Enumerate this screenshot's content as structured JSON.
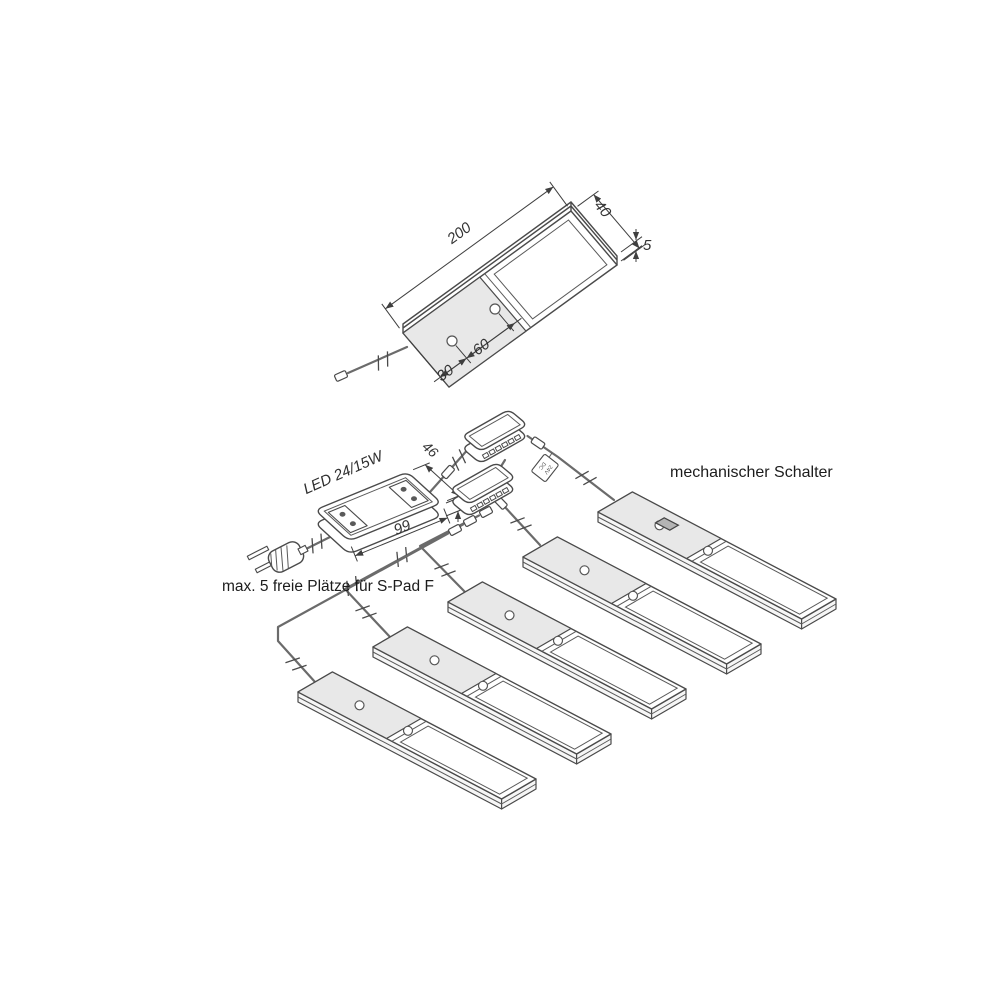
{
  "product_drawing": {
    "length": "200",
    "width": "40",
    "thickness": "5",
    "hole_edge_distance": "30",
    "hole_spacing": "60"
  },
  "driver": {
    "label": "LED 24/15W",
    "width": "46",
    "height": "15",
    "length": "99"
  },
  "cable_tag": {
    "line1": "24V",
    "line2": "DC"
  },
  "labels": {
    "switch": "mechanischer Schalter",
    "note": "max. 5 freie Plätze für S-Pad F"
  },
  "distributors": {
    "count": 2,
    "ports_each": 6
  },
  "panels": {
    "count": 5
  },
  "colors": {
    "background": "#ffffff",
    "line": "#4a4a4a",
    "wire": "#6b6b6b",
    "plate_gray": "#e8e8e8",
    "switch_gray": "#b4b4b4"
  }
}
